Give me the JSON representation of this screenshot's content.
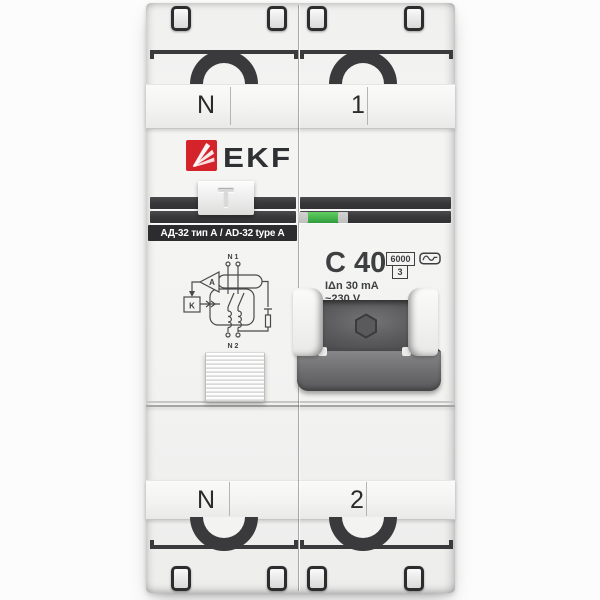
{
  "product": {
    "brand": "EKF",
    "model_label": "АД-32 тип А / AD-32 type A",
    "test_handle_label": "T",
    "rating": "C 40",
    "breaking_capacity": "6000",
    "energy_limiting_class": "3",
    "residual_current": "IΔn 30 mA",
    "voltage": "~230 V",
    "terminals": {
      "top": [
        "N",
        "1"
      ],
      "bottom": [
        "N",
        "2"
      ]
    },
    "diagram": {
      "top_terminals": "N 1",
      "bottom_terminals": "N 2",
      "amplifier": "A",
      "relay": "K"
    },
    "icons": {
      "logo": "ekf-fan-icon",
      "type_symbol": "type-a-sine-icon",
      "indicator": "position-indicator-window"
    },
    "colors": {
      "brand_red": "#d4232b",
      "indicator_green": "#3fae47",
      "panel_dark": "#3a3a3c",
      "body_light": "#f2f2f1",
      "marking_text": "#3d3f41"
    }
  }
}
